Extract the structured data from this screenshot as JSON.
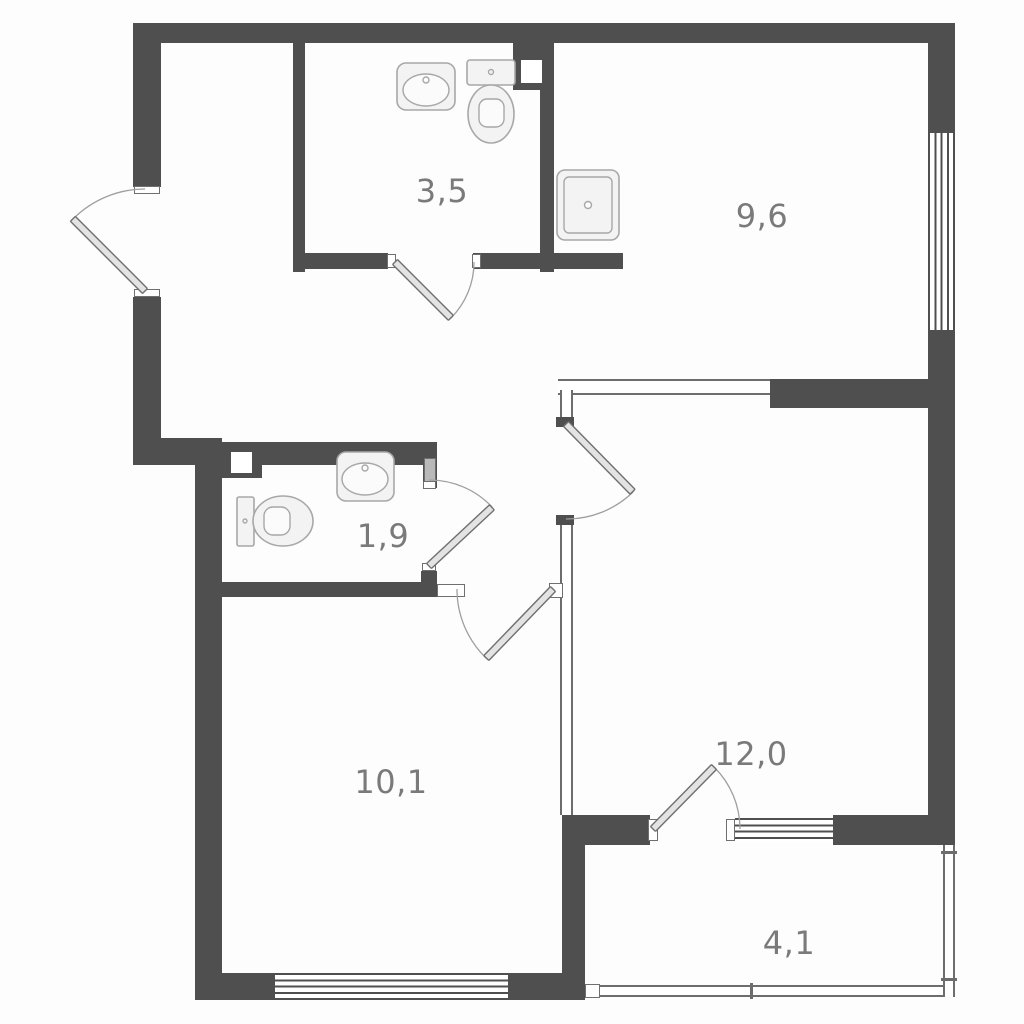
{
  "plan": {
    "room_area_labels": [
      "3,5",
      "9,6",
      "1,9",
      "10,1",
      "12,0",
      "4,1"
    ],
    "fixture_icons": [
      "washbasin-icon",
      "toilet-icon",
      "kitchen-sink-icon",
      "toilet-icon",
      "washbasin-icon"
    ],
    "colors": {
      "wall": "#4f4f4f",
      "thin_line": "#6d6d6d",
      "door_leaf": "#e3e3e3",
      "door_arc": "#9f9f9f",
      "fixture_outline": "#a8a8a8",
      "label_text": "#7a7a7a",
      "background": "#fdfdfd"
    }
  }
}
